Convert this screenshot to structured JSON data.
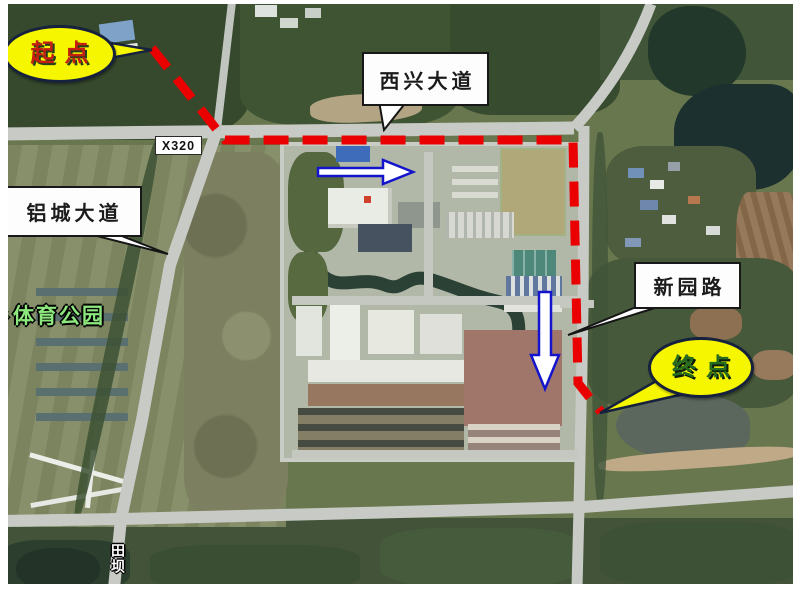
{
  "map": {
    "description_type": "annotated-satellite-route-map",
    "callouts": {
      "start": {
        "label": "起点",
        "bubble_fill": "#f6f600",
        "bubble_border": "#16213d",
        "text_color": "#c5200f"
      },
      "end": {
        "label": "终点",
        "bubble_fill": "#f6f600",
        "bubble_border": "#16213d",
        "text_color": "#256b20"
      }
    },
    "road_labels": {
      "xixing": {
        "label": "西兴大道"
      },
      "lvcheng": {
        "label": "铝城大道"
      },
      "xinyuan": {
        "label": "新园路"
      },
      "route_code": {
        "label": "X320"
      }
    },
    "map_text": {
      "park_partial": "彡",
      "park": "体育公园",
      "park_color": "#8ce87c",
      "village": "田坝"
    },
    "route": {
      "color": "#ea0000",
      "style": "dashed",
      "dash": "25 14",
      "width": 9,
      "points": [
        [
          152,
          48
        ],
        [
          225,
          140
        ],
        [
          573,
          140
        ],
        [
          578,
          383
        ],
        [
          601,
          412
        ]
      ]
    },
    "arrows": {
      "outline_color": "#1414cc",
      "fill": "#ffffff",
      "east_points": [
        [
          318,
          168
        ],
        [
          383,
          168
        ],
        [
          383,
          160
        ],
        [
          413,
          172
        ],
        [
          383,
          184
        ],
        [
          383,
          176
        ],
        [
          318,
          176
        ]
      ],
      "south_points": [
        [
          539,
          292
        ],
        [
          551,
          292
        ],
        [
          551,
          355
        ],
        [
          559,
          355
        ],
        [
          545,
          389
        ],
        [
          531,
          355
        ],
        [
          539,
          355
        ]
      ]
    },
    "callout_tails": {
      "start": [
        [
          105,
          42
        ],
        [
          152,
          50
        ],
        [
          105,
          59
        ]
      ],
      "end": [
        [
          658,
          380
        ],
        [
          697,
          391
        ],
        [
          600,
          413
        ]
      ]
    },
    "pointer_tails": {
      "xixing": [
        [
          379,
          101
        ],
        [
          407,
          101
        ],
        [
          384,
          130
        ]
      ],
      "lvcheng": [
        [
          77,
          231
        ],
        [
          109,
          231
        ],
        [
          168,
          254
        ]
      ],
      "xinyuan": [
        [
          646,
          303
        ],
        [
          671,
          303
        ],
        [
          568,
          335
        ]
      ]
    }
  }
}
